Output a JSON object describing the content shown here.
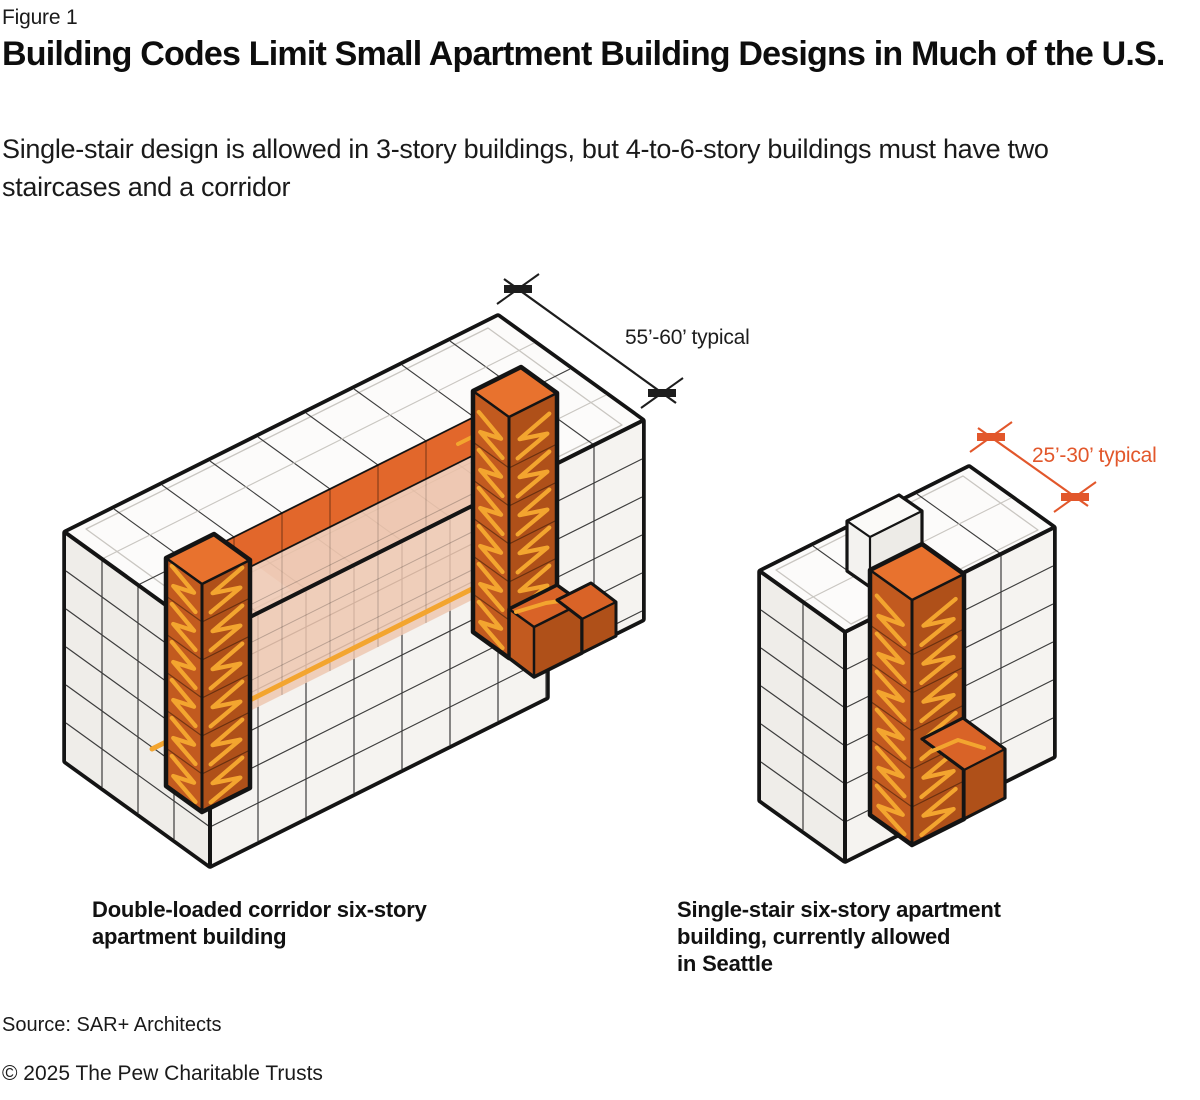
{
  "figure_label": "Figure 1",
  "title": "Building Codes Limit Small Apartment Building Designs in Much of the U.S.",
  "subtitle": "Single-stair design is allowed in 3-story buildings, but 4-to-6-story buildings must have two staircases and a corridor",
  "diagram": {
    "left_building": {
      "name": "double-loaded corridor six-story apartment building",
      "stories": 6,
      "staircases": 2,
      "has_corridor": true,
      "dimension_label": "55’-60’ typical",
      "caption_line1": "Double-loaded corridor six-story",
      "caption_line2": "apartment building"
    },
    "right_building": {
      "name": "single-stair six-story apartment building",
      "stories": 6,
      "staircases": 1,
      "has_corridor": false,
      "dimension_label": "25’-30’ typical",
      "caption_line1": "Single-stair six-story apartment",
      "caption_line2": "building, currently allowed",
      "caption_line3": "in Seattle"
    },
    "colors": {
      "outline": "#141414",
      "building_fill": "#F6F5F2",
      "roof_fill": "#FCFBFA",
      "front_face_fill": "#F5F3F0",
      "end_face_fill": "#EFEDE9",
      "grid_line": "#3C3C3C",
      "faint_line": "#C9C6C1",
      "corridor_orange": "#E2672B",
      "corridor_plane": "#EDC7B0",
      "tower_end_face": "#C25A1F",
      "tower_front_face": "#AF5019",
      "tower_top": "#E8722E",
      "vestibule_top": "#D96327",
      "stair_yellow": "#F3A52F",
      "dimension_black": "#1D1D1D",
      "dimension_orange": "#E2572B"
    }
  },
  "source": "Source: SAR+ Architects",
  "copyright": "© 2025 The Pew Charitable Trusts"
}
